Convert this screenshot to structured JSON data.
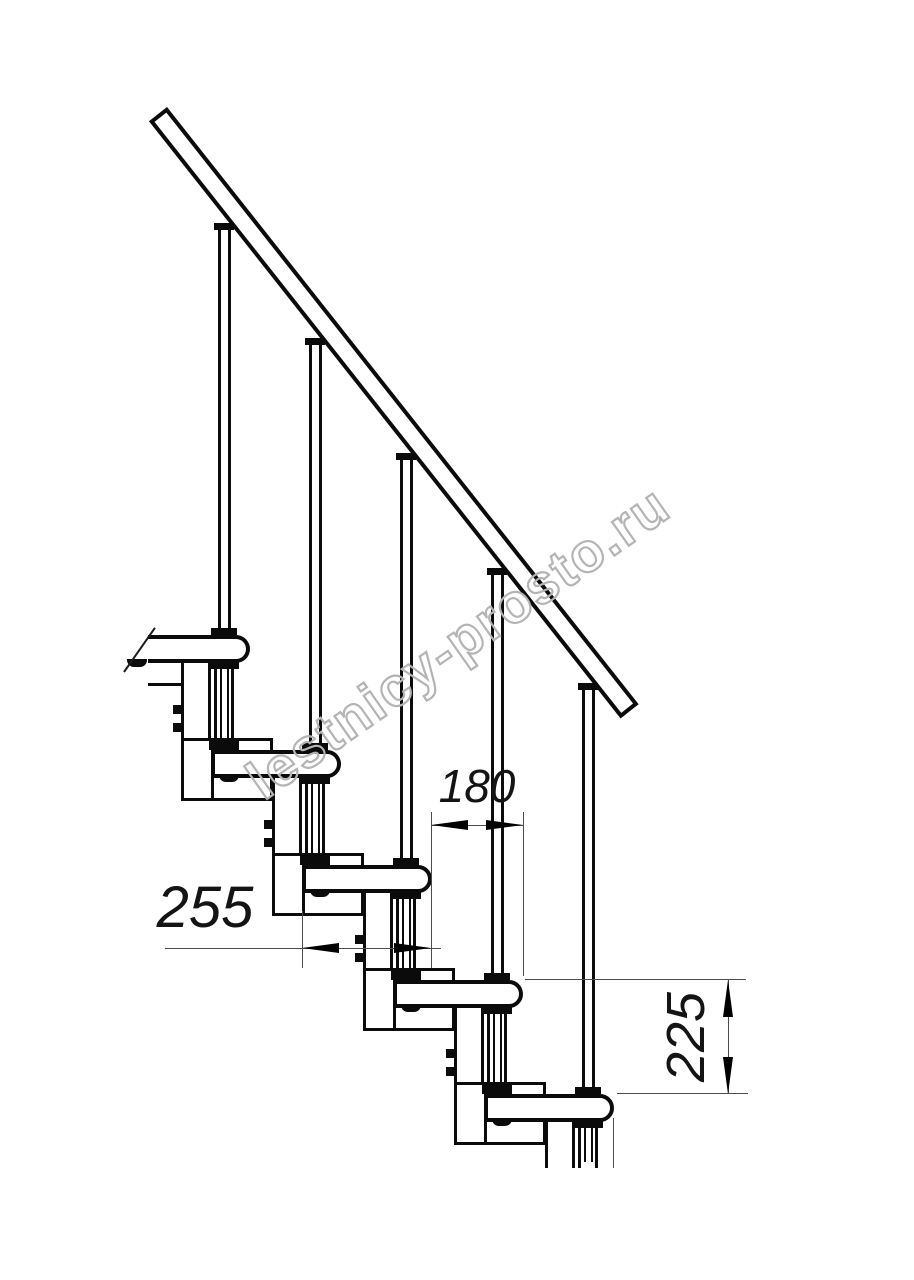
{
  "title": "Modular staircase side-view drawing",
  "watermark": {
    "text": "lestnicy-prosto.ru",
    "color": "#b4b4b4"
  },
  "dims": {
    "run": {
      "label": "180",
      "text_xy": [
        477,
        786
      ],
      "font": 46,
      "rotated": false,
      "line_h": [
        431,
        523,
        825
      ],
      "ext_v": [
        [
          431,
          812,
          968
        ],
        [
          523,
          812,
          976
        ]
      ],
      "arrows": [
        [
          "left",
          431,
          825
        ],
        [
          "right",
          523,
          825
        ]
      ]
    },
    "depth": {
      "label": "255",
      "text_xy": [
        205,
        908
      ],
      "font": 58,
      "rotated": false,
      "line_h": [
        165,
        441,
        948
      ],
      "ext_v": [
        [
          302,
          911,
          968
        ]
      ],
      "arrows": [
        [
          "left",
          302,
          948
        ],
        [
          "right",
          431,
          948
        ]
      ]
    },
    "rise": {
      "label": "225",
      "text_xy": [
        686,
        1037
      ],
      "font": 54,
      "rotated": true,
      "line_v": [
        728,
        980,
        1094
      ],
      "ext_h": [
        [
          525,
          746,
          979
        ],
        [
          617,
          748,
          1093
        ]
      ],
      "arrows": [
        [
          "up",
          728,
          980
        ],
        [
          "down",
          728,
          1094
        ]
      ]
    }
  },
  "drawing": {
    "canvas": {
      "w": 914,
      "h": 1280
    },
    "steps": 5,
    "tread_tops": [
      635,
      750,
      865,
      980,
      1094
    ],
    "tread_rights": [
      250,
      341,
      432,
      523,
      614
    ],
    "tread_len": 130,
    "tread_h": 24,
    "first_tread_left": 148,
    "rail": {
      "x": 167,
      "y": 107,
      "len": 761,
      "th": 23,
      "angle_deg": 51.7
    },
    "baluster": {
      "w": 13,
      "offset_from_right": 26,
      "flange_tops": [
        223,
        338,
        453,
        568,
        683
      ]
    },
    "riser": {
      "w": 20
    },
    "bracket": {
      "w": 30,
      "offset_from_right": 69
    },
    "clamp": {
      "w": 92,
      "above": 12,
      "below": 51
    },
    "clamp0_stub": {
      "x1": 148,
      "x2": 181,
      "y": 683
    },
    "cut_y": 1168,
    "cut_edge_x": 613,
    "break_line": {
      "x": 124,
      "y": 671
    },
    "bolt_tab": {
      "w": 10,
      "h": 9,
      "dy1": 45,
      "dy2": 27
    },
    "nub": {
      "w": 20,
      "h": 8,
      "dx_from_clamp_left": 38,
      "clamp0_left": 89
    }
  }
}
